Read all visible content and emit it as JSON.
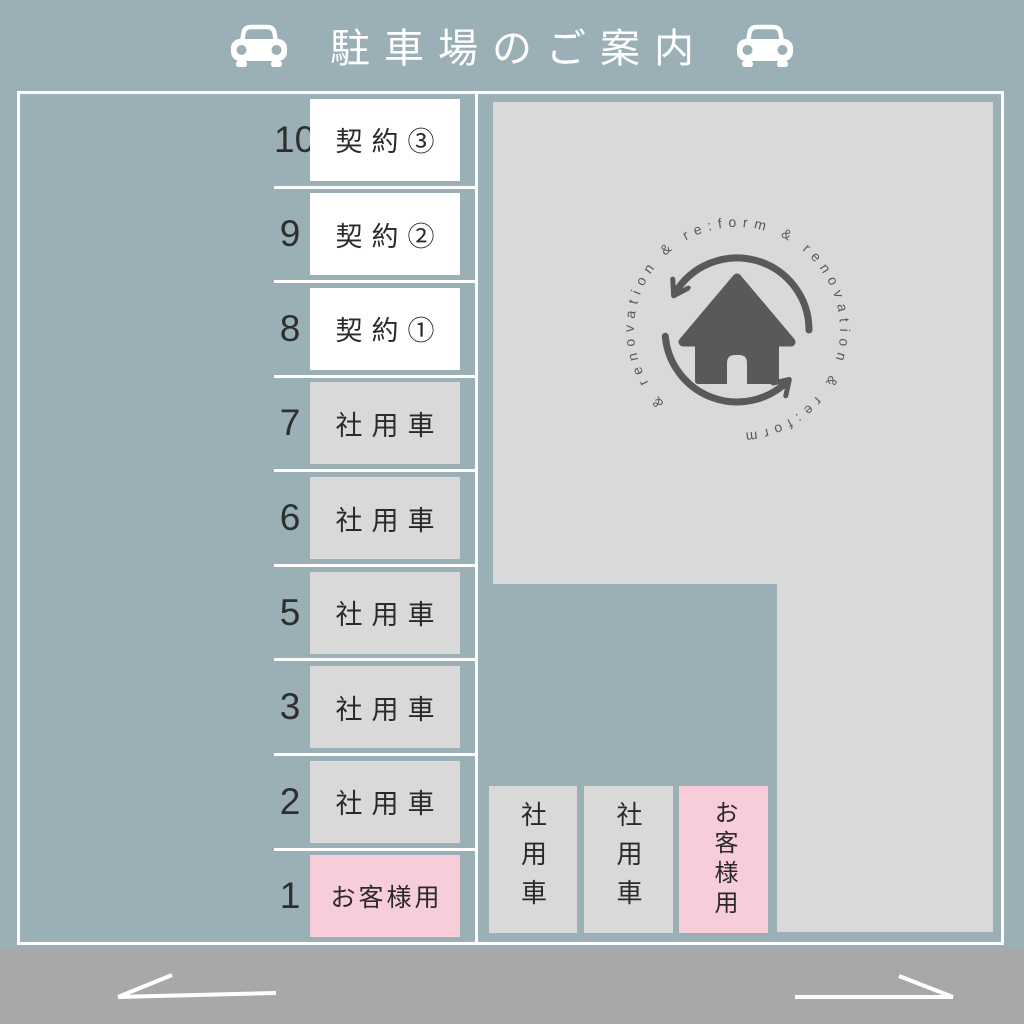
{
  "title": {
    "text": "駐車場のご案内"
  },
  "left_column": {
    "spots": [
      {
        "number": "10",
        "label": "契約③",
        "type": "contract"
      },
      {
        "number": "9",
        "label": "契約②",
        "type": "contract"
      },
      {
        "number": "8",
        "label": "契約①",
        "type": "contract"
      },
      {
        "number": "7",
        "label": "社用車",
        "type": "company"
      },
      {
        "number": "6",
        "label": "社用車",
        "type": "company"
      },
      {
        "number": "5",
        "label": "社用車",
        "type": "company"
      },
      {
        "number": "3",
        "label": "社用車",
        "type": "company"
      },
      {
        "number": "2",
        "label": "社用車",
        "type": "company"
      },
      {
        "number": "1",
        "label": "お客様用",
        "type": "customer"
      }
    ]
  },
  "bottom_row": {
    "spots": [
      {
        "label": "社用車",
        "type": "company"
      },
      {
        "label": "社用車",
        "type": "company"
      },
      {
        "label": "お客様用",
        "type": "customer"
      }
    ]
  },
  "logo": {
    "circular_text": "& renovation & re:form & renovation & re:form ",
    "icon": "house-icon"
  },
  "road": {
    "arrows": [
      "left",
      "right"
    ]
  },
  "colors": {
    "background": "#9AAFB6",
    "building": "#D9D9D9",
    "spot_white": "#FFFFFF",
    "spot_gray": "#D9D9D9",
    "spot_pink": "#F6CDD9",
    "road": "#A8A8A8",
    "lines": "#FFFFFF",
    "text_dark": "#2E2E2E",
    "logo": "#595959"
  }
}
